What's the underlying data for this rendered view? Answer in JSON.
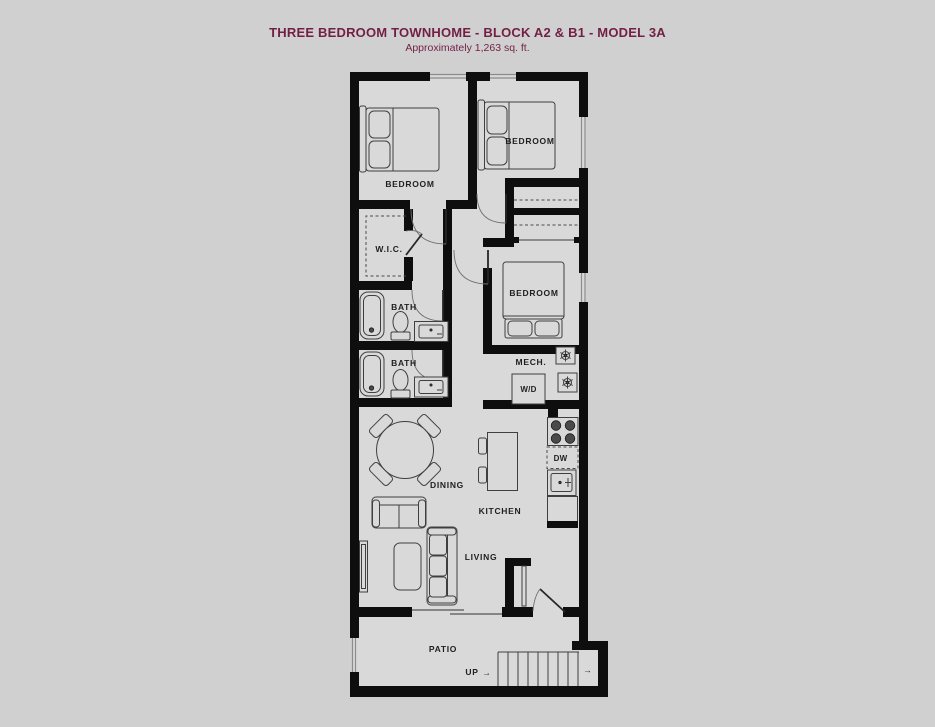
{
  "header": {
    "title": "THREE BEDROOM TOWNHOME - BLOCK A2 & B1 - MODEL 3A",
    "subtitle": "Approximately 1,263 sq. ft."
  },
  "rooms": {
    "bedroom1": "BEDROOM",
    "bedroom2": "BEDROOM",
    "bedroom3": "BEDROOM",
    "wic": "W.I.C.",
    "bath1": "BATH",
    "bath2": "BATH",
    "mech": "MECH.",
    "dining": "DINING",
    "kitchen": "KITCHEN",
    "living": "LIVING",
    "patio": "PATIO"
  },
  "fixtures": {
    "washer_dryer": "W/D",
    "dishwasher": "DW"
  },
  "stairs": {
    "up_label": "UP",
    "up_arrow": "→",
    "exit_arrow": "→"
  },
  "colors": {
    "background": "#d0d0d0",
    "floor": "#d9d9d9",
    "wall": "#0e0e0e",
    "title_text": "#731f44",
    "label_text": "#1f1f1f"
  }
}
